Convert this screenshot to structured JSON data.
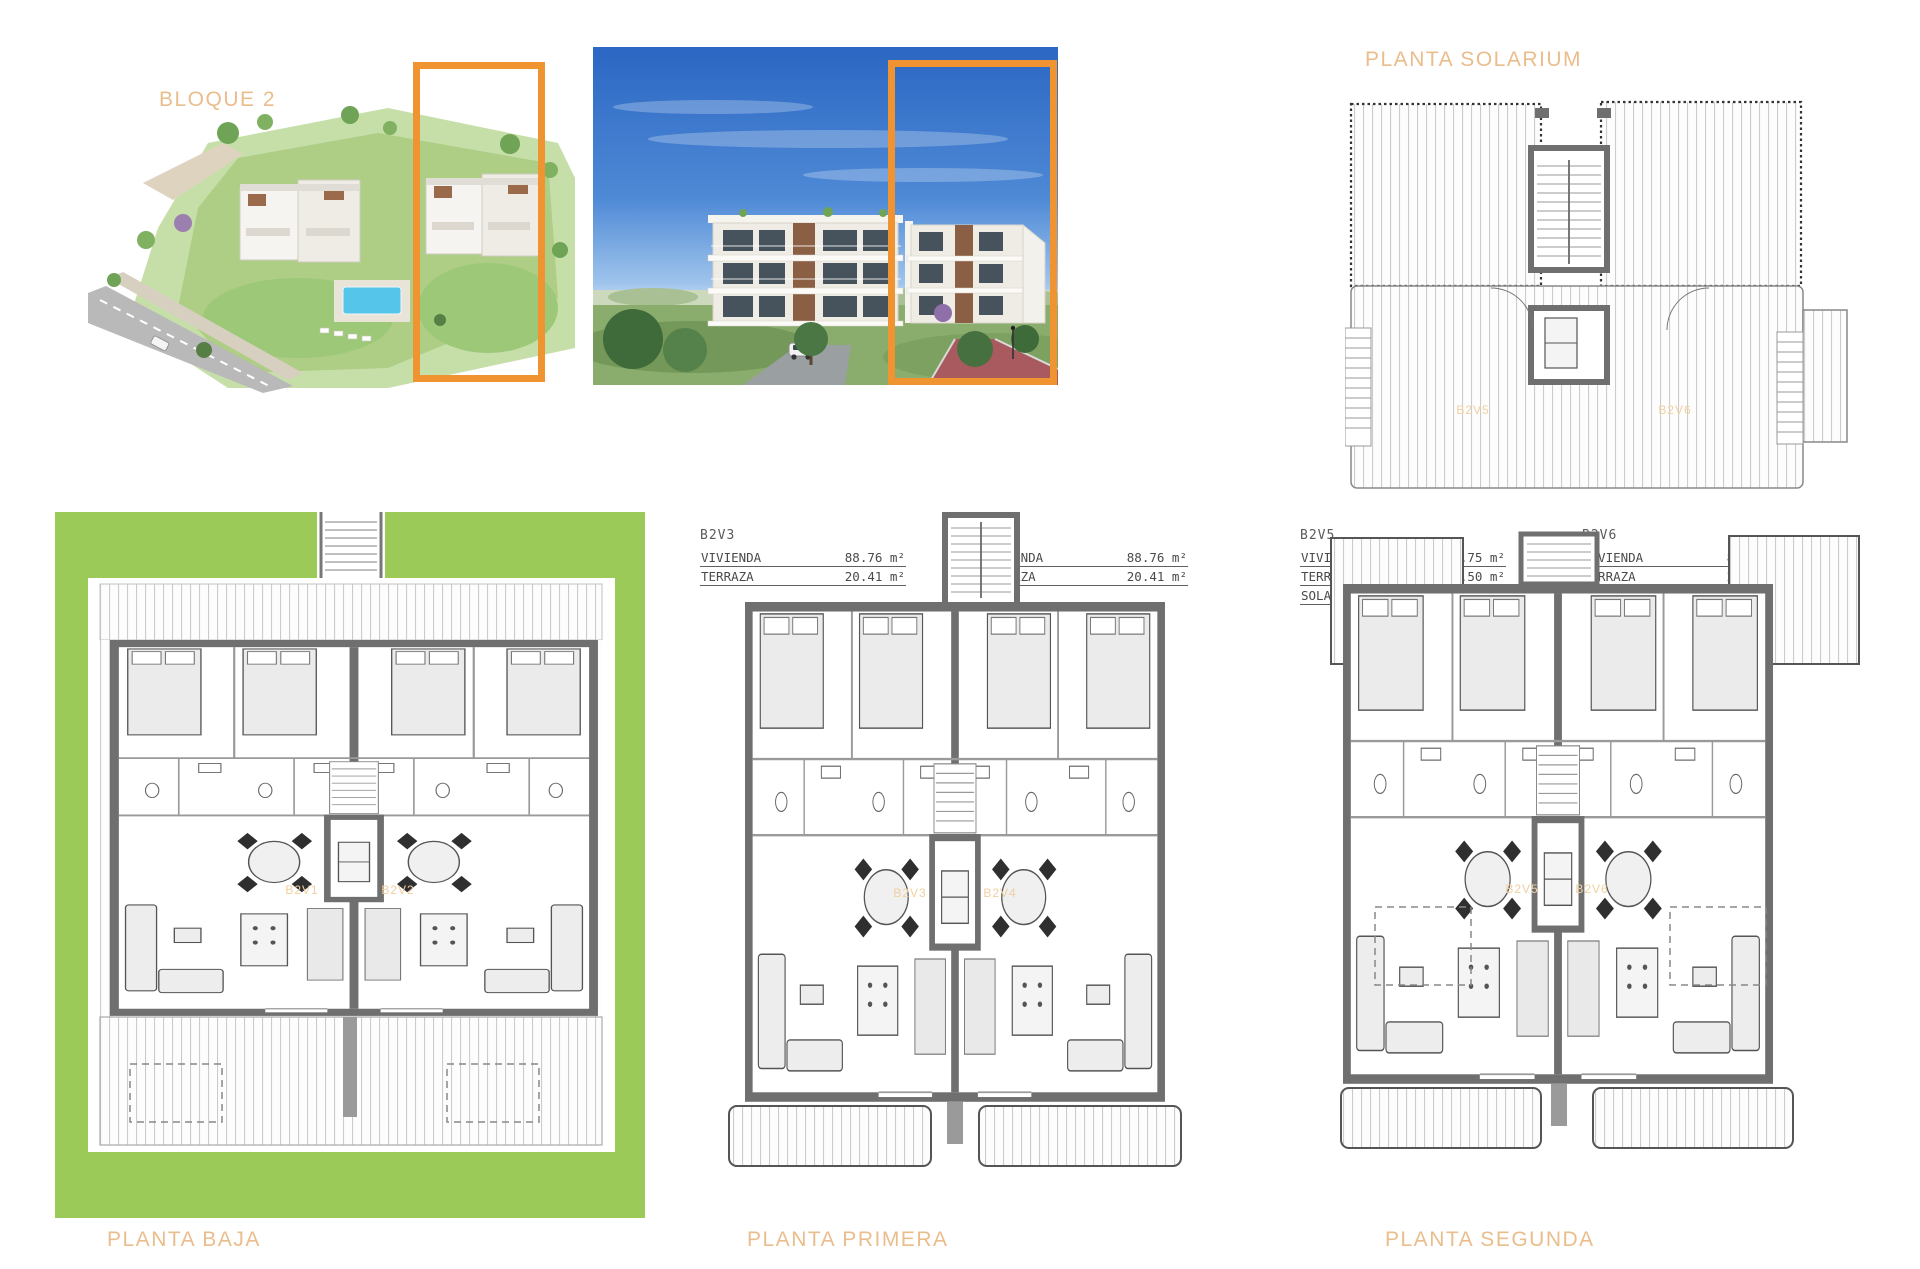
{
  "labels": {
    "bloque": "BLOQUE 2",
    "solarium": "PLANTA SOLARIUM",
    "baja": "PLANTA BAJA",
    "primera": "PLANTA PRIMERA",
    "segunda": "PLANTA SEGUNDA"
  },
  "colors": {
    "accent_orange": "#EF9430",
    "title_tan": "#EABD8C",
    "plan_label_tan": "#F0D0A0",
    "garden_green": "#9CCA58",
    "wall_gray": "#6f6f6f",
    "sky_blue": "#2B67C3"
  },
  "unit_tables": [
    {
      "id": "B2V1",
      "rows": [
        {
          "label": "VIVIENDA",
          "value": "92.47 m²"
        },
        {
          "label": "TERRAZA",
          "value": "22.59 m²"
        },
        {
          "label": "JARDÍN",
          "value": "208.91 m²"
        }
      ]
    },
    {
      "id": "B2V2",
      "rows": [
        {
          "label": "VIVIENDA",
          "value": "92.47 m²"
        },
        {
          "label": "TERRAZA",
          "value": "22.59 m²"
        },
        {
          "label": "JARDÍN",
          "value": "306.96 m²"
        }
      ]
    },
    {
      "id": "B2V3",
      "rows": [
        {
          "label": "VIVIENDA",
          "value": "88.76 m²"
        },
        {
          "label": "TERRAZA",
          "value": "20.41 m²"
        }
      ]
    },
    {
      "id": "B2V4",
      "rows": [
        {
          "label": "VIVIENDA",
          "value": "88.76 m²"
        },
        {
          "label": "TERRAZA",
          "value": "20.41 m²"
        }
      ]
    },
    {
      "id": "B2V5",
      "rows": [
        {
          "label": "VIVIENDA",
          "value": "81.75 m²"
        },
        {
          "label": "TERRAZA",
          "value": "24.50 m²"
        },
        {
          "label": "SOLARIUM",
          "value": "45.19 m²"
        }
      ]
    },
    {
      "id": "B2V6",
      "rows": [
        {
          "label": "VIVIENDA",
          "value": "81.75 m²"
        },
        {
          "label": "TERRAZA",
          "value": "24.50 m²"
        },
        {
          "label": "SOLARIUM",
          "value": "45.19 m²"
        }
      ]
    }
  ],
  "plan_unit_labels": {
    "baja": [
      "B2V1",
      "B2V2"
    ],
    "primera": [
      "B2V3",
      "B2V4"
    ],
    "segunda": [
      "B2V5",
      "B2V6"
    ],
    "solarium": [
      "B2V5",
      "B2V6"
    ]
  }
}
